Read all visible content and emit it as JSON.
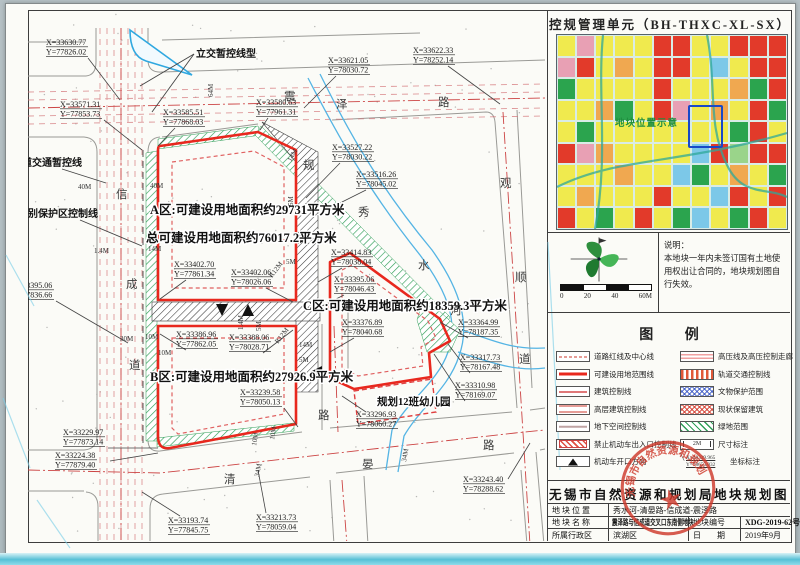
{
  "panel_right": {
    "unit_title": "控规管理单元（BH-THXC-XL-SX）",
    "minimap": {
      "label": "地块位置示意",
      "palette": {
        "Y": "#f0ea4e",
        "R": "#e23a2a",
        "G": "#2ba44e",
        "B": "#7cc8e8",
        "O": "#f0a850",
        "P": "#e8a0b4",
        "L": "#9ad48a"
      },
      "grid": [
        "YPYYYRRYYRRR",
        "PRYOYRRYBYRR",
        "GYYYYRYYYOGR",
        "YYOGYRPYOYRG",
        "YGYYYYYYYGRY",
        "RPOYYYYBRLRR",
        "YYYOYYBGYOYG",
        "YOYYYRYYBRYR",
        "RYGYRYGBYGRY"
      ]
    },
    "compass_scale": {
      "ticks": [
        "0",
        "20",
        "40",
        "60M"
      ]
    },
    "note": {
      "title": "说明：",
      "body": "本地块一年内未签订国有土地使用权出让合同的，地块规划图自行失效。"
    },
    "legend": {
      "title": "图 例",
      "left": [
        {
          "label": "道路红线及中心线",
          "swatch": "road"
        },
        {
          "label": "可建设用地范围线",
          "swatch": "buildable"
        },
        {
          "label": "建筑控制线",
          "swatch": "building"
        },
        {
          "label": "高层建筑控制线",
          "swatch": "highrise"
        },
        {
          "label": "地下空间控制线",
          "swatch": "underground"
        },
        {
          "label": "禁止机动车出入口控制线",
          "swatch": "noentry"
        },
        {
          "label": "机动车开口方向",
          "swatch": "opening"
        }
      ],
      "right": [
        {
          "label": "高压线及高压控制走廊",
          "swatch": "hv"
        },
        {
          "label": "轨道交通控制线",
          "swatch": "rail"
        },
        {
          "label": "文物保护范围",
          "swatch": "relic"
        },
        {
          "label": "现状保留建筑",
          "swatch": "retained"
        },
        {
          "label": "绿地范围",
          "swatch": "green"
        },
        {
          "label": "尺寸标注",
          "swatch": "dim"
        },
        {
          "label": "坐标标注",
          "swatch": "coordsample",
          "sample_x": "X=40339.965",
          "sample_y": "Y=78655.032"
        }
      ]
    },
    "titleblock": {
      "title": "无锡市自然资源和规划局地块规划图",
      "row1_label": "地块位置",
      "row1_value": "秀水河-清晏路-信成道-震泽路",
      "row2_label": "地块名称",
      "row2_value": "震泽路与信成道交叉口东南侧地块",
      "row2_label2": "地块编号",
      "row2_value2": "XDG-2019-62号",
      "row3_label": "所属行政区",
      "row3_value": "滨湖区",
      "row3_label2": "日　　期",
      "row3_value2": "2019年9月"
    },
    "seal_text": "无锡市自然资源和规划局"
  },
  "map": {
    "area_labels": [
      {
        "t": "A区:可建设用地面积约29731平方米",
        "x": 150,
        "y": 214,
        "s": 12.5
      },
      {
        "t": "总可建设用地面积约76017.2平方米",
        "x": 146,
        "y": 242,
        "s": 12.5
      },
      {
        "t": "B区:可建设用地面积约27926.9平方米",
        "x": 150,
        "y": 381,
        "s": 12.5
      },
      {
        "t": "C区:可建设用地面积约18359.3平方米",
        "x": 303,
        "y": 310,
        "s": 12.5
      },
      {
        "t": "规划12班幼儿园",
        "x": 377,
        "y": 405,
        "s": 10.5
      }
    ],
    "callouts": [
      {
        "t": "立交暂控线型",
        "x": 196,
        "y": 57,
        "leads": [
          [
            194,
            54,
            140,
            86
          ],
          [
            194,
            54,
            152,
            112
          ]
        ]
      },
      {
        "t": "轨道交通暂控线",
        "x": 12,
        "y": 166,
        "leads": [
          [
            62,
            169,
            106,
            183
          ]
        ]
      },
      {
        "t": "特别保护区控制线",
        "x": 18,
        "y": 217,
        "leads": [
          [
            80,
            220,
            142,
            246
          ]
        ]
      }
    ],
    "coord_labels": [
      {
        "x": 46,
        "y": 38,
        "xt": "X=33630.77",
        "yt": "Y=77826.02",
        "lead": [
          88,
          58,
          120,
          100
        ]
      },
      {
        "x": 60,
        "y": 100,
        "xt": "X=33571.31",
        "yt": "Y=77853.73",
        "lead": [
          104,
          120,
          142,
          150
        ]
      },
      {
        "x": 163,
        "y": 108,
        "xt": "X=33585.51",
        "yt": "Y=77868.03",
        "lead": [
          175,
          128,
          158,
          146
        ]
      },
      {
        "x": 256,
        "y": 98,
        "xt": "X=33580.63",
        "yt": "Y=77961.31",
        "lead": [
          268,
          118,
          260,
          130
        ]
      },
      {
        "x": 328,
        "y": 56,
        "xt": "X=33621.05",
        "yt": "Y=78030.72",
        "lead": [
          336,
          76,
          304,
          108
        ]
      },
      {
        "x": 413,
        "y": 46,
        "xt": "X=33622.33",
        "yt": "Y=78252.14",
        "lead": [
          448,
          66,
          500,
          104
        ]
      },
      {
        "x": 332,
        "y": 143,
        "xt": "X=33527.22",
        "yt": "Y=78030.22",
        "lead": [
          340,
          163,
          306,
          198
        ]
      },
      {
        "x": 356,
        "y": 170,
        "xt": "X=33516.26",
        "yt": "Y=78045.02",
        "lead": [
          366,
          190,
          318,
          214
        ]
      },
      {
        "x": 174,
        "y": 260,
        "xt": "X=33402.70",
        "yt": "Y=77861.34",
        "lead": [
          186,
          280,
          160,
          299
        ]
      },
      {
        "x": 231,
        "y": 268,
        "xt": "X=33402.06",
        "yt": "Y=78026.06",
        "lead": [
          266,
          288,
          293,
          302
        ]
      },
      {
        "x": 331,
        "y": 248,
        "xt": "X=33414.83",
        "yt": "Y=78038.04",
        "lead": [
          342,
          268,
          318,
          282
        ]
      },
      {
        "x": 334,
        "y": 275,
        "xt": "X=33395.06",
        "yt": "Y=78046.43",
        "lead": [
          344,
          295,
          322,
          306
        ]
      },
      {
        "x": 12,
        "y": 281,
        "xt": "X=33395.06",
        "yt": "Y=77836.66",
        "lead": [
          56,
          301,
          128,
          343
        ]
      },
      {
        "x": 176,
        "y": 330,
        "xt": "X=33386.96",
        "yt": "Y=77862.05",
        "lead": [
          186,
          350,
          160,
          334
        ]
      },
      {
        "x": 229,
        "y": 333,
        "xt": "X=33388.06",
        "yt": "Y=78028.71",
        "lead": [
          263,
          353,
          293,
          330
        ]
      },
      {
        "x": 342,
        "y": 318,
        "xt": "X=33376.89",
        "yt": "Y=78040.68",
        "lead": [
          354,
          338,
          330,
          352
        ]
      },
      {
        "x": 458,
        "y": 318,
        "xt": "X=33364.99",
        "yt": "Y=78187.35",
        "lead": [
          468,
          338,
          440,
          322
        ]
      },
      {
        "x": 460,
        "y": 353,
        "xt": "X=33317.73",
        "yt": "Y=78167.48",
        "lead": [
          470,
          373,
          448,
          344
        ]
      },
      {
        "x": 455,
        "y": 381,
        "xt": "X=33310.98",
        "yt": "Y=78169.07",
        "lead": [
          465,
          401,
          434,
          354
        ]
      },
      {
        "x": 356,
        "y": 410,
        "xt": "X=33296.93",
        "yt": "Y=78060.27",
        "lead": [
          366,
          412,
          342,
          396
        ]
      },
      {
        "x": 240,
        "y": 388,
        "xt": "X=33239.58",
        "yt": "Y=78050.13",
        "lead": [
          284,
          408,
          298,
          427
        ]
      },
      {
        "x": 63,
        "y": 428,
        "xt": "X=33229.97",
        "yt": "Y=77873.14",
        "lead": [
          108,
          448,
          158,
          448
        ]
      },
      {
        "x": 55,
        "y": 451,
        "xt": "X=33224.38",
        "yt": "Y=77879.40",
        "lead": [
          110,
          461,
          158,
          453
        ]
      },
      {
        "x": 168,
        "y": 516,
        "xt": "X=33193.74",
        "yt": "Y=77845.75",
        "lead": [
          180,
          516,
          142,
          492
        ]
      },
      {
        "x": 256,
        "y": 513,
        "xt": "X=33213.73",
        "yt": "Y=78059.04",
        "lead": [
          266,
          513,
          258,
          470
        ]
      },
      {
        "x": 463,
        "y": 475,
        "xt": "X=33243.40",
        "yt": "Y=78288.62",
        "lead": [
          508,
          479,
          530,
          443
        ]
      }
    ],
    "road_chars": [
      {
        "c": "震",
        "x": 284,
        "y": 100
      },
      {
        "c": "泽",
        "x": 336,
        "y": 108
      },
      {
        "c": "路",
        "x": 438,
        "y": 106
      },
      {
        "c": "信",
        "x": 116,
        "y": 198
      },
      {
        "c": "成",
        "x": 126,
        "y": 288
      },
      {
        "c": "道",
        "x": 129,
        "y": 369
      },
      {
        "c": "清",
        "x": 224,
        "y": 483
      },
      {
        "c": "晏",
        "x": 362,
        "y": 468
      },
      {
        "c": "路",
        "x": 483,
        "y": 449
      },
      {
        "c": "观",
        "x": 500,
        "y": 187
      },
      {
        "c": "顺",
        "x": 515,
        "y": 281
      },
      {
        "c": "道",
        "x": 519,
        "y": 363
      },
      {
        "c": "秀",
        "x": 358,
        "y": 216
      },
      {
        "c": "水",
        "x": 418,
        "y": 269
      },
      {
        "c": "河",
        "x": 450,
        "y": 314
      },
      {
        "c": "规",
        "x": 303,
        "y": 169
      },
      {
        "c": "路",
        "x": 318,
        "y": 419
      }
    ],
    "dims": [
      {
        "t": "40M",
        "x": 78,
        "y": 189
      },
      {
        "t": "40M",
        "x": 150,
        "y": 188
      },
      {
        "t": "64M",
        "x": 213,
        "y": 97,
        "r": -90
      },
      {
        "t": "1.4M",
        "x": 94,
        "y": 253
      },
      {
        "t": "14M",
        "x": 148,
        "y": 251
      },
      {
        "t": "30M",
        "x": 120,
        "y": 341
      },
      {
        "t": "10M",
        "x": 145,
        "y": 339
      },
      {
        "t": "10M",
        "x": 158,
        "y": 355
      },
      {
        "t": "5M",
        "x": 286,
        "y": 264
      },
      {
        "t": "R12M",
        "x": 272,
        "y": 278,
        "r": -52
      },
      {
        "t": "R12M",
        "x": 278,
        "y": 344,
        "r": -52
      },
      {
        "t": "14M",
        "x": 299,
        "y": 347
      },
      {
        "t": "5M",
        "x": 299,
        "y": 362
      },
      {
        "t": "1.4M",
        "x": 243,
        "y": 330,
        "r": -90
      },
      {
        "t": "5M",
        "x": 261,
        "y": 331,
        "r": -90
      },
      {
        "t": "10M",
        "x": 256,
        "y": 446,
        "r": -80
      },
      {
        "t": "10M",
        "x": 274,
        "y": 440,
        "r": -80
      },
      {
        "t": "34M",
        "x": 259,
        "y": 477,
        "r": -80
      },
      {
        "t": "34M",
        "x": 406,
        "y": 462,
        "r": -80
      },
      {
        "t": "14M",
        "x": 291,
        "y": 162,
        "r": -60
      },
      {
        "t": "5M",
        "x": 293,
        "y": 206,
        "r": -90
      }
    ]
  }
}
